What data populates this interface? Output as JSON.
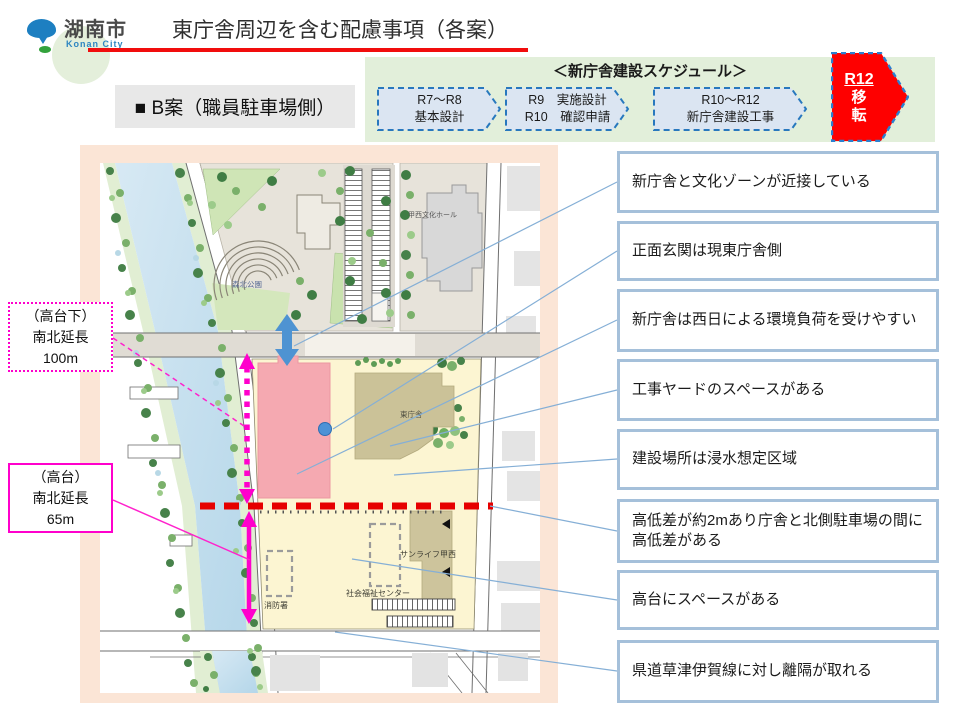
{
  "header": {
    "logo": {
      "city_name": "湖南市",
      "city_name_en": "Konan City"
    },
    "title": "東庁舎周辺を含む配慮事項（各案）"
  },
  "plan_label": "■ B案（職員駐車場側）",
  "schedule": {
    "title": "＜新庁舎建設スケジュール＞",
    "steps": [
      {
        "line1": "R7～R8",
        "line2": "基本設計"
      },
      {
        "line1": "R9　実施設計",
        "line2": "R10　確認申請"
      },
      {
        "line1": "R10～R12",
        "line2": "新庁舎建設工事"
      }
    ],
    "final": {
      "year": "R12",
      "label_char1": "移",
      "label_char2": "転"
    }
  },
  "left_labels": [
    {
      "lines": [
        "（高台下）",
        "南北延長",
        "100m"
      ]
    },
    {
      "lines": [
        "（高台）",
        "南北延長",
        "65m"
      ]
    }
  ],
  "map": {
    "labels": {
      "culture_hall": "甲西文化ホール",
      "park": "森北公園",
      "east_building": "東庁舎",
      "sunlife": "サンライフ甲西",
      "welfare_center": "社会福祉センター",
      "fire_station": "消防署"
    }
  },
  "callouts": [
    "新庁舎と文化ゾーンが近接している",
    "正面玄関は現東庁舎側",
    "新庁舎は西日による環境負荷を受けやすい",
    "工事ヤードのスペースがある",
    "建設場所は浸水想定区域",
    "高低差が約2mあり庁舎と北側駐車場の間に高低差がある",
    "高台にスペースがある",
    "県道草津伊賀線に対し離隔が取れる"
  ],
  "colors": {
    "accent_magenta": "#ff00cc",
    "accent_red_line": "#e60000",
    "schedule_bg": "#e2efda",
    "callout_border": "#a5c0da",
    "map_frame": "#fbe5d6",
    "site_yellow": "#fcf5d2",
    "new_building_pink": "#f5a9b1",
    "final_arrow_red": "#fe0000"
  }
}
